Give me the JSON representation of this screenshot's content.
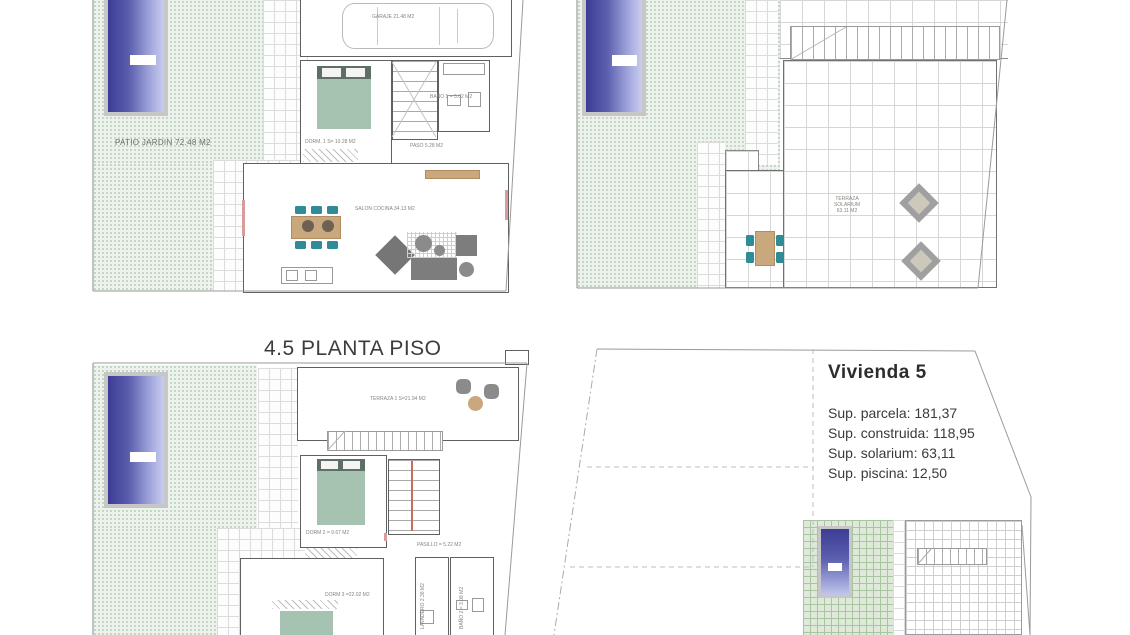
{
  "ground_floor": {
    "patio_label": "PATIO JARDIN 72.48 M2",
    "garage_label": "GARAJE 21.48 M2",
    "dorm1_label": "DORM. 1 S= 10.28 M2",
    "bath1_label": "BAÑO 1 = 5.02 M2",
    "paso_label": "PASO 5.28 M2",
    "salon_label": "SALON COCINA 34.13 M2"
  },
  "solarium": {
    "terrace_label_line1": "TERRAZA",
    "terrace_label_line2": "SOLARIUM",
    "terrace_label_line3": "63.11 M2"
  },
  "first_floor": {
    "title": "4.5 PLANTA PISO",
    "terrace_label": "TERRAZA 1 S=21.94 M2",
    "dorm2_label": "DORM 2 = 9.67 M2",
    "pasillo_label": "PASILLO = 5.22 M2",
    "dorm3_label": "DORM 3 =22.02 M2",
    "lavadero_label": "LAVADERO 2.38 M2",
    "bath2_label": "BAÑO 2 = 3.08 M2"
  },
  "site_plan": {
    "title": "Vivienda 5",
    "stats": [
      "Sup. parcela: 181,37",
      "Sup. construida: 118,95",
      "Sup. solarium: 63,11",
      "Sup. piscina: 12,50"
    ],
    "plot_number": "4.5"
  },
  "colors": {
    "pool_dark": "#3c3c95",
    "pool_light": "#cacdf0",
    "patio_green": "#edf3ec",
    "green_grid": "#a9c4a1",
    "bed_teal": "#a6c2b1",
    "bed_headboard": "#5e6f66",
    "chair_teal": "#2f8b96",
    "table_tan": "#c9a87e",
    "sofa_gray": "#7d7d7d",
    "wall_gray": "#606060",
    "accent_red": "#d89c9c"
  }
}
